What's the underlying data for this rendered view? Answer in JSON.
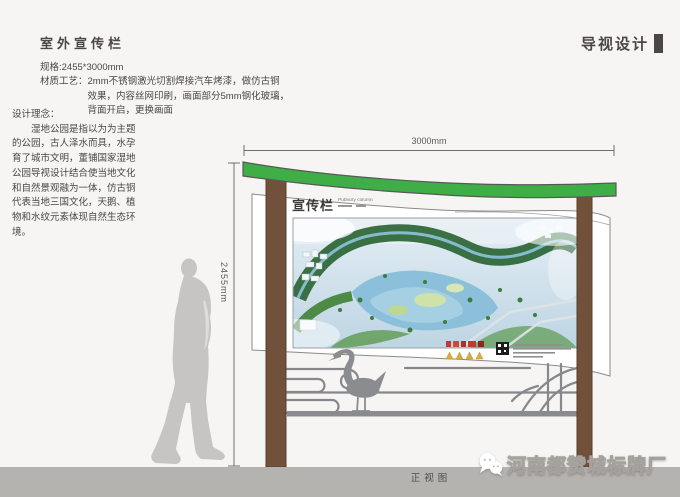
{
  "header": {
    "left_title": "室外宣传栏",
    "right_title": "导视设计"
  },
  "specs": {
    "size_line": "规格:2455*3000mm",
    "material_label": "材质工艺：",
    "material_lines": [
      "2mm不锈钢激光切割焊接汽车烤漆，做仿古铜",
      "效果，内容丝网印刷，画面部分5mm钢化玻璃，",
      "背面开启，更换画面"
    ]
  },
  "concept": {
    "label": "设计理念：",
    "body": "湿地公园是指以为为主题的公园，古人泽水而具，水孕育了城市文明，董铺国家湿地公园导视设计结合使当地文化和自然景观融为一体，仿古铜代表当地三国文化，天鹅、植物和水纹元素体现自然生态环境。"
  },
  "dimensions": {
    "width": "3000mm",
    "height": "2455mm"
  },
  "board": {
    "title": "宣传栏",
    "subtitle": "Publicity column"
  },
  "footer": {
    "view_label": "正视图",
    "watermark": "河南都赞城标牌厂"
  },
  "colors": {
    "background": "#f6f5f3",
    "ink": "#4a4745",
    "green_band": "#3fae47",
    "post_brown": "#72513a",
    "lattice_gray": "#87888b",
    "silhouette_gray": "#c6c5c3",
    "ground_bar": "#b5b3b0",
    "watermark_white": "#ffffff"
  }
}
